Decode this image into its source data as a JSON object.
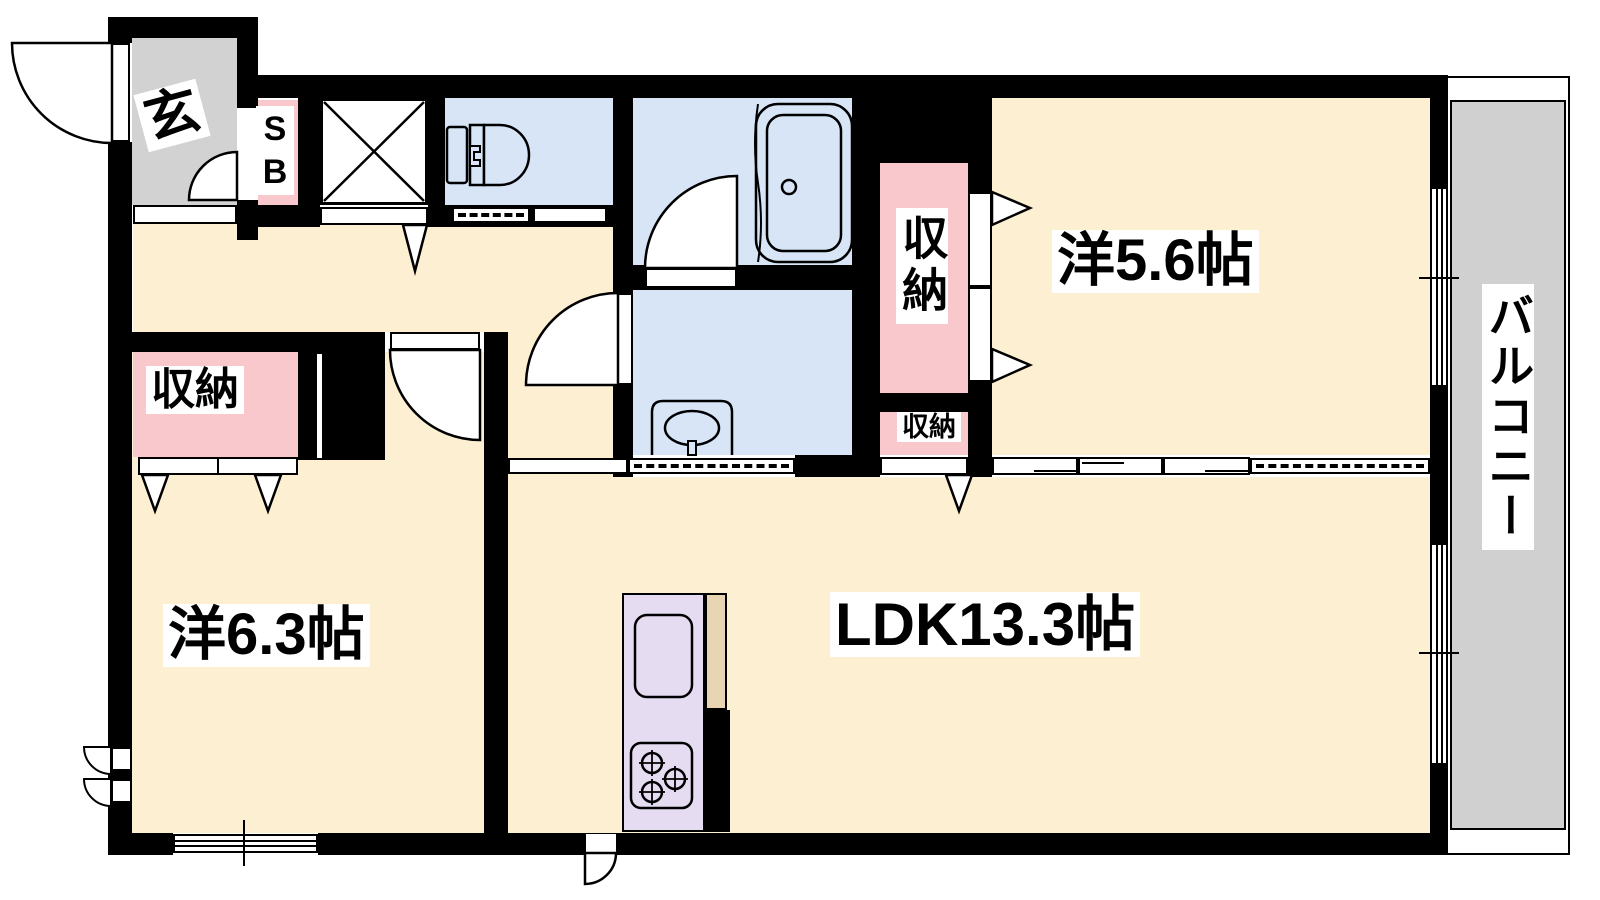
{
  "plan_title": "apartment-floor-plan",
  "rooms": {
    "entrance": {
      "label": "玄"
    },
    "shoe_box": {
      "label": "SB"
    },
    "western_room_56": {
      "label": "洋5.6帖"
    },
    "western_room_63": {
      "label": "洋6.3帖"
    },
    "ldk": {
      "label": "LDK13.3帖"
    },
    "balcony": {
      "label": "バルコニー"
    },
    "storage_right_tall": {
      "label": "収納"
    },
    "storage_right_small": {
      "label": "収納"
    },
    "storage_left": {
      "label": "収納"
    }
  },
  "colors": {
    "room_floor": "#fcefd2",
    "wet_area": "#d7e5f7",
    "storage": "#f9c8cc",
    "entrance_gray": "#d2d2d2",
    "balcony_gray": "#d0d0d0",
    "kitchen_counter": "#e5dcf2",
    "counter_top": "#e8d5b4",
    "wall": "#000000",
    "background": "#ffffff"
  }
}
